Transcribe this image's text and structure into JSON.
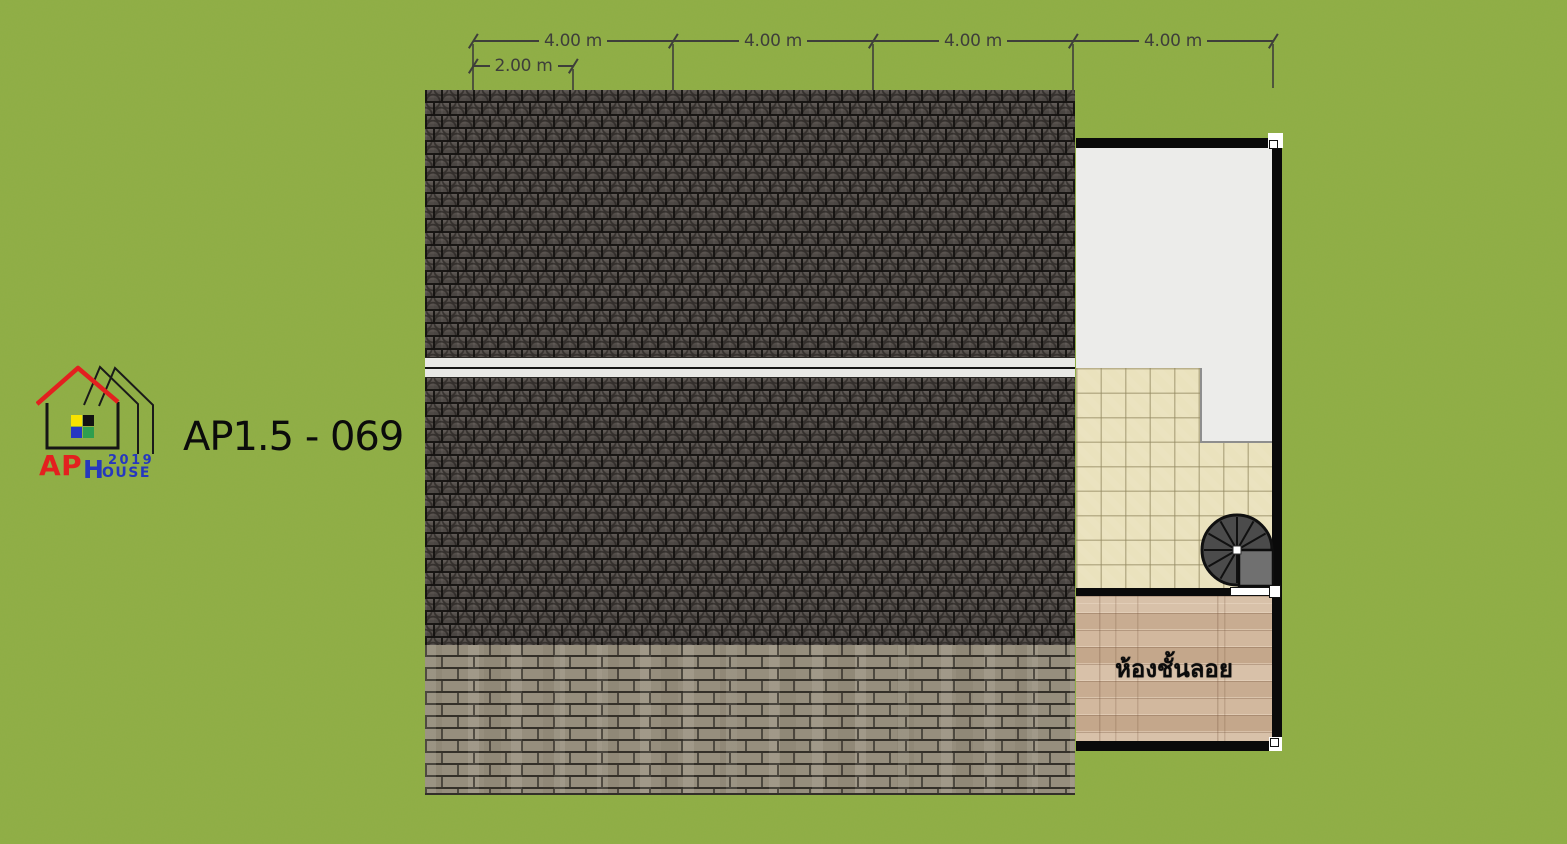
{
  "plan": {
    "code": "AP1.5 - 069",
    "mezzanine_room_label": "ห้องชั้นลอย"
  },
  "logo": {
    "brand_ap": "AP",
    "brand_h": "H",
    "brand_year": "2019",
    "brand_ouse": "OUSE"
  },
  "dimensions": {
    "top_segments": [
      "4.00 m",
      "4.00 m",
      "4.00 m",
      "4.00 m"
    ],
    "sub_segment": "2.00 m"
  },
  "icons": {
    "spiral_staircase": "spiral-staircase-icon",
    "logo_houses": "house-outlines-icon"
  },
  "colors": {
    "grass": "#8FAE45",
    "dim_text": "#3E3E3A",
    "roof_dark": "#59534F",
    "ridge": "#E9E9E6",
    "roof_eave": "#968E7D",
    "tile": "#EAE2BD",
    "wood": "#CDB399",
    "floor_white": "#ECECEA",
    "wall": "#0A0A0A",
    "stair": "#4B4B4B",
    "logo_red": "#E3201F",
    "logo_blue": "#2638BE",
    "logo_yellow": "#F7E300",
    "logo_green": "#2E9E4F"
  }
}
